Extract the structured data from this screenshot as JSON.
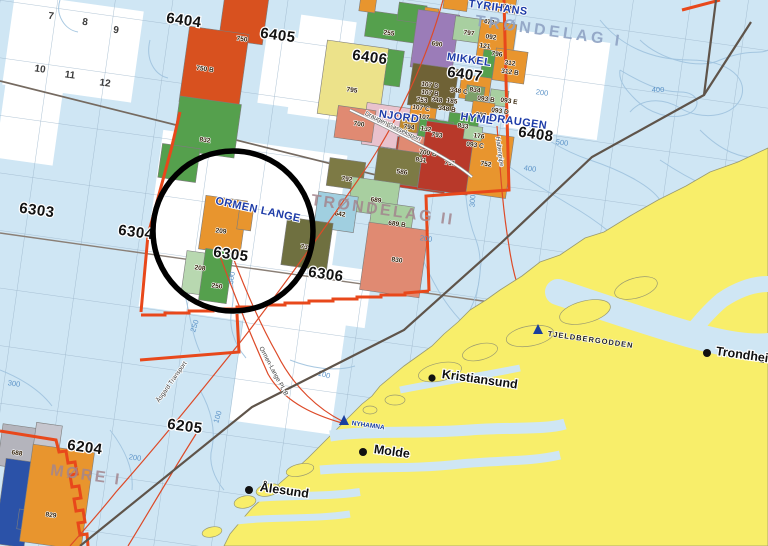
{
  "map_title": "Norwegian Sea licence map - Ormen Lange area",
  "colors": {
    "sea": "#cfe6f4",
    "land": "#f8ee6a",
    "land_edge": "#9a9a70",
    "boundary_orange": "#e8481b",
    "sector_line": "#5f544a",
    "pipeline_red": "#dd4a28",
    "contour_blue": "#9fc2de",
    "field_label_blue": "#1e3ca8",
    "block_orange": "#e8952e",
    "block_red": "#d8511f",
    "block_darkred": "#c23b28",
    "block_salmon": "#e08a72",
    "block_green": "#55a04d",
    "block_lightgreen": "#a8cfa0",
    "block_palegreen": "#b8d8b0",
    "block_olive": "#7d7a45",
    "block_brown": "#6f6236",
    "block_purple": "#9b7cb8",
    "block_yellow": "#ece28a",
    "block_pink": "#e9c2cd",
    "block_cyan": "#a0cfe0",
    "block_gray": "#b4b4bc",
    "block_blue": "#2b52a8",
    "annotation_circle": "#000000"
  },
  "quadrants": {
    "q6404": "6404",
    "q6405": "6405",
    "q6406": "6406",
    "q6407": "6407",
    "q6408": "6408",
    "q6303": "6303",
    "q6304": "6304",
    "q6305": "6305",
    "q6306": "6306",
    "q6204": "6204",
    "q6205": "6205"
  },
  "grid_numbers": {
    "n7": "7",
    "n8": "8",
    "n9": "9",
    "n10": "10",
    "n11": "11",
    "n12": "12"
  },
  "regions": {
    "trondelag1": "TRØNDELAG I",
    "trondelag2": "TRØNDELAG II",
    "more1": "MØRE I"
  },
  "fields": {
    "tyrihans": "TYRIHANS",
    "mikkel": "MIKKEL",
    "njord": "NJORD",
    "hyme": "HYME",
    "draugen": "DRAUGEN",
    "ormen_lange": "ORMEN LANGE"
  },
  "facilities": {
    "nyhamna": "NYHAMNA",
    "tjeldbergodden": "TJELDBERGODDEN"
  },
  "cities": {
    "kristiansund": "Kristiansund",
    "molde": "Molde",
    "alesund": "Ålesund",
    "trondheim": "Trondheim"
  },
  "pipelines": {
    "asgard": "Åsgard Transport",
    "ormen_pl_b": "Ormen-Lange PL-B",
    "draugen_gass": "Draugen Gasseksport",
    "haltenpipe": "Haltenpipe"
  },
  "depths": {
    "d100": "100",
    "d200": "200",
    "d250": "250",
    "d300": "300",
    "d400": "400",
    "d500": "500"
  },
  "blocks": {
    "b750": "750",
    "b750B": "750 B",
    "b832": "832",
    "b255": "255",
    "b690": "690",
    "b797": "797",
    "b092": "092",
    "b121": "121",
    "b796": "796",
    "b473": "473",
    "b835": "B 835",
    "b312": "312",
    "b312B": "312 B",
    "b795": "795",
    "b701": "701",
    "b107": "107",
    "b794": "794",
    "b132": "132",
    "b107D": "107 D",
    "b107B": "107 B",
    "b753": "753",
    "b348": "348",
    "b185": "185",
    "b348C": "348 C",
    "b834": "834",
    "b107C": "107 C",
    "b348B": "348 B",
    "b833": "833",
    "b093": "093",
    "b093B": "093 B",
    "b093E": "093 E",
    "b093D": "093 D",
    "b176": "176",
    "b093C": "093 C",
    "b793": "793",
    "b700": "700",
    "b700B": "700 B",
    "b586": "586",
    "b831": "831",
    "b751": "751",
    "b752": "752",
    "b792": "792",
    "b689": "689",
    "b642": "642",
    "b689B": "689 B",
    "b739": "739",
    "b830": "830",
    "b209": "209",
    "b208": "208",
    "b250": "250",
    "b688": "688",
    "b829": "829"
  }
}
